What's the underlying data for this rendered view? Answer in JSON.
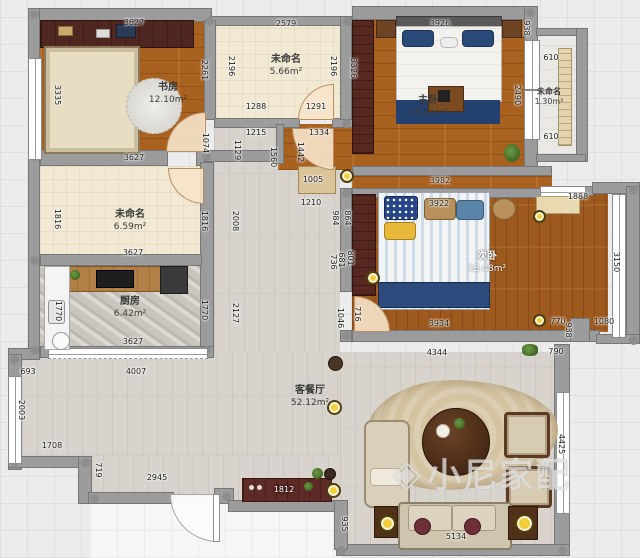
{
  "watermark": {
    "text": "小尼家配",
    "logo": "cube-logo"
  },
  "colors": {
    "wood_floor": "#a9611f",
    "wardrobe_maroon": "#56281f",
    "bed_navy": "#24406e",
    "floor_gray": "#d8d4cd",
    "cream_floor": "#f2e9d4",
    "lamp_yellow": "#f2cf3a",
    "wall_gray": "#9c9c9c"
  },
  "rooms": [
    {
      "id": "study",
      "name": "书房",
      "area": "12.10m²"
    },
    {
      "id": "cloak",
      "name": "未命名",
      "area": "5.66m²"
    },
    {
      "id": "master",
      "name": "主卧",
      "area": "16.64m²"
    },
    {
      "id": "balcony",
      "name": "未命名",
      "area": "1.30m²"
    },
    {
      "id": "storage",
      "name": "未命名",
      "area": "6.59m²"
    },
    {
      "id": "kitchen",
      "name": "厨房",
      "area": "6.42m²"
    },
    {
      "id": "second",
      "name": "次卧",
      "area": "18.48m²"
    },
    {
      "id": "living",
      "name": "客餐厅",
      "area": "52.12m²"
    }
  ],
  "dimensions": [
    {
      "t": "3627",
      "x": 134,
      "y": 23
    },
    {
      "t": "2579",
      "x": 286,
      "y": 24
    },
    {
      "t": "3926",
      "x": 440,
      "y": 24
    },
    {
      "t": "938",
      "x": 526,
      "y": 28,
      "v": 1
    },
    {
      "t": "610",
      "x": 551,
      "y": 58
    },
    {
      "t": "610",
      "x": 551,
      "y": 137
    },
    {
      "t": "3335",
      "x": 57,
      "y": 95,
      "v": 1
    },
    {
      "t": "2261",
      "x": 204,
      "y": 70,
      "v": 1
    },
    {
      "t": "2196",
      "x": 231,
      "y": 66,
      "v": 1
    },
    {
      "t": "2196",
      "x": 333,
      "y": 66,
      "v": 1
    },
    {
      "t": "3326",
      "x": 353,
      "y": 68,
      "v": 1
    },
    {
      "t": "2490",
      "x": 517,
      "y": 95,
      "v": 1
    },
    {
      "t": "1288",
      "x": 256,
      "y": 107
    },
    {
      "t": "1291",
      "x": 316,
      "y": 107
    },
    {
      "t": "3627",
      "x": 134,
      "y": 158
    },
    {
      "t": "1074",
      "x": 205,
      "y": 143,
      "v": 1
    },
    {
      "t": "1215",
      "x": 256,
      "y": 133
    },
    {
      "t": "1334",
      "x": 319,
      "y": 133
    },
    {
      "t": "1129",
      "x": 237,
      "y": 150,
      "v": 1
    },
    {
      "t": "1560",
      "x": 273,
      "y": 157,
      "v": 1
    },
    {
      "t": "1442",
      "x": 300,
      "y": 152,
      "v": 1
    },
    {
      "t": "1005",
      "x": 313,
      "y": 180
    },
    {
      "t": "1210",
      "x": 311,
      "y": 203
    },
    {
      "t": "984",
      "x": 335,
      "y": 218,
      "v": 1
    },
    {
      "t": "864",
      "x": 347,
      "y": 218,
      "v": 1
    },
    {
      "t": "736",
      "x": 333,
      "y": 262,
      "v": 1
    },
    {
      "t": "681",
      "x": 341,
      "y": 260,
      "v": 1
    },
    {
      "t": "801",
      "x": 350,
      "y": 258,
      "v": 1
    },
    {
      "t": "2008",
      "x": 235,
      "y": 221,
      "v": 1
    },
    {
      "t": "2127",
      "x": 235,
      "y": 313,
      "v": 1
    },
    {
      "t": "1816",
      "x": 57,
      "y": 219,
      "v": 1
    },
    {
      "t": "1816",
      "x": 204,
      "y": 221,
      "v": 1
    },
    {
      "t": "3627",
      "x": 133,
      "y": 253
    },
    {
      "t": "1770",
      "x": 58,
      "y": 311,
      "v": 1
    },
    {
      "t": "1770",
      "x": 204,
      "y": 310,
      "v": 1
    },
    {
      "t": "3627",
      "x": 133,
      "y": 342
    },
    {
      "t": "3982",
      "x": 440,
      "y": 181
    },
    {
      "t": "3922",
      "x": 439,
      "y": 204
    },
    {
      "t": "1888",
      "x": 578,
      "y": 197
    },
    {
      "t": "3150",
      "x": 616,
      "y": 262,
      "v": 1
    },
    {
      "t": "3934",
      "x": 439,
      "y": 324
    },
    {
      "t": "770",
      "x": 558,
      "y": 322
    },
    {
      "t": "1080",
      "x": 604,
      "y": 322
    },
    {
      "t": "716",
      "x": 357,
      "y": 314,
      "v": 1
    },
    {
      "t": "1046",
      "x": 340,
      "y": 318,
      "v": 1
    },
    {
      "t": "4344",
      "x": 437,
      "y": 353
    },
    {
      "t": "790",
      "x": 556,
      "y": 352
    },
    {
      "t": "693",
      "x": 28,
      "y": 372
    },
    {
      "t": "4007",
      "x": 136,
      "y": 372
    },
    {
      "t": "2003",
      "x": 21,
      "y": 410,
      "v": 1
    },
    {
      "t": "1708",
      "x": 52,
      "y": 446
    },
    {
      "t": "719",
      "x": 98,
      "y": 470,
      "v": 1
    },
    {
      "t": "2945",
      "x": 157,
      "y": 478
    },
    {
      "t": "1812",
      "x": 284,
      "y": 490,
      "l": 1
    },
    {
      "t": "935",
      "x": 344,
      "y": 524,
      "v": 1
    },
    {
      "t": "4425",
      "x": 561,
      "y": 444,
      "v": 1
    },
    {
      "t": "5134",
      "x": 456,
      "y": 537
    },
    {
      "t": "938",
      "x": 568,
      "y": 330,
      "v": 1
    }
  ]
}
